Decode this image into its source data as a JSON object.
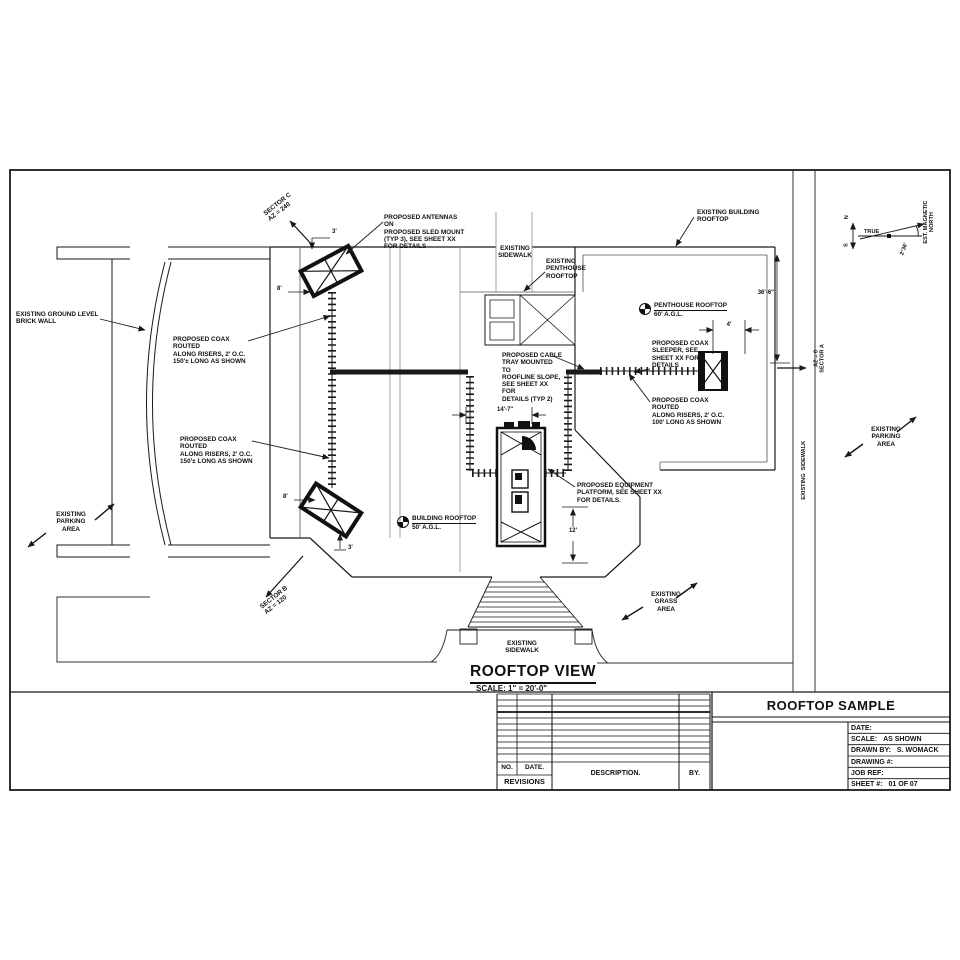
{
  "colors": {
    "ink": "#1a1a1a",
    "secondary_line": "#8c8c8c"
  },
  "drawing": {
    "view_title": "ROOFTOP VIEW",
    "view_scale": "SCALE: 1\" = 20'-0\"",
    "labels": {
      "sector_c": "SECTOR C\nAZ = 240",
      "sector_b": "SECTOR B\nAZ = 120",
      "sector_a": "AZ = 0\nSECTOR A",
      "proposed_antennas": "PROPOSED ANTENNAS ON\nPROPOSED SLED MOUNT\n(TYP 3), SEE SHEET XX\nFOR DETAILS",
      "existing_building_rooftop": "EXISTING BUILDING\nROOFTOP",
      "existing_sidewalk_top": "EXISTING\nSIDEWALK",
      "existing_penthouse_rooftop": "EXISTING\nPENTHOUSE\nROOFTOP",
      "penthouse_elev_name": "PENTHOUSE ROOFTOP",
      "penthouse_elev_value": "60' A.G.L.",
      "building_elev_name": "BUILDING ROOFTOP",
      "building_elev_value": "50' A.G.L.",
      "brick_wall": "EXISTING GROUND LEVEL\nBRICK WALL",
      "coax_150_upper": "PROPOSED COAX ROUTED\nALONG RISERS, 2' O.C.\n150'± LONG AS SHOWN",
      "coax_150_lower": "PROPOSED COAX ROUTED\nALONG RISERS, 2' O.C.\n150'± LONG AS SHOWN",
      "coax_sleeper": "PROPOSED COAX\nSLEEPER, SEE\nSHEET XX FOR\nDETAILS",
      "cable_tray": "PROPOSED CABLE\nTRAY MOUNTED TO\nROOFLINE SLOPE,\nSEE SHEET XX FOR\nDETAILS (TYP 2)",
      "coax_100": "PROPOSED COAX ROUTED\nALONG RISERS, 2' O.C.\n100' LONG AS SHOWN",
      "equipment_platform": "PROPOSED EQUIPMENT\nPLATFORM, SEE SHEET XX\nFOR DETAILS.",
      "parking_left": "EXISTING\nPARKING\nAREA",
      "parking_right": "EXISTING\nPARKING\nAREA",
      "grass": "EXISTING\nGRASS\nAREA",
      "sidewalk_bottom": "EXISTING\nSIDEWALK",
      "sidewalk_right": "EXISTING  SIDEWALK"
    },
    "dimensions": {
      "antenna_top_offset": "3'",
      "antenna_top_width": "8'",
      "antenna_bottom_width": "8'",
      "antenna_bottom_offset": "3'",
      "roof_depth": "36'-6\"",
      "sleeper_offset": "4'",
      "tray_span": "14'-7\"",
      "platform_offset": "12'"
    },
    "compass": {
      "north": "N",
      "south": "S",
      "true_label": "TRUE",
      "magnetic": "EST. MAGNETIC\nNORTH",
      "declination": "2°36'"
    }
  },
  "title_strip": {
    "revisions": {
      "no": "NO.",
      "date": "DATE.",
      "description": "DESCRIPTION.",
      "by": "BY.",
      "title": "REVISIONS"
    },
    "title_block": {
      "project": "ROOFTOP SAMPLE",
      "rows": [
        {
          "label": "DATE:",
          "value": ""
        },
        {
          "label": "SCALE:",
          "value": "AS SHOWN"
        },
        {
          "label": "DRAWN BY:",
          "value": "S. WOMACK"
        },
        {
          "label": "DRAWING #:",
          "value": ""
        },
        {
          "label": "JOB REF:",
          "value": ""
        },
        {
          "label": "SHEET #:",
          "value": "01 OF 07"
        }
      ]
    }
  }
}
